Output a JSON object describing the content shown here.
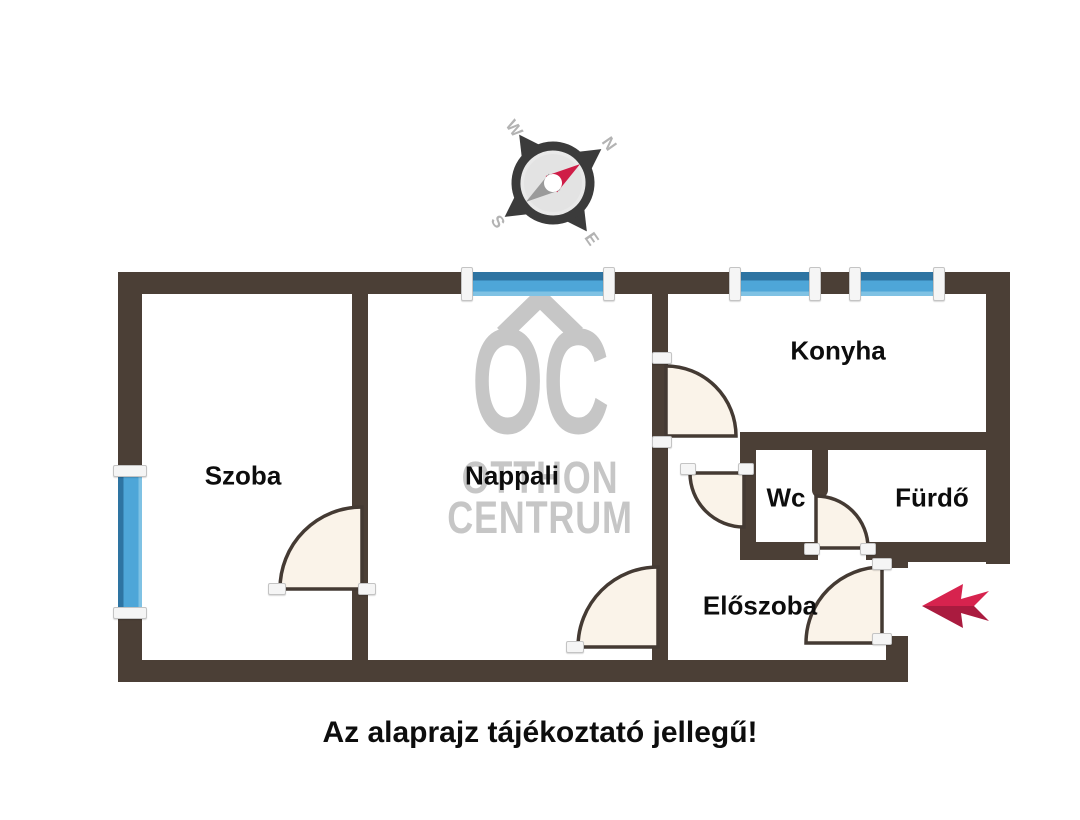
{
  "caption": "Az alaprajz tájékoztató jellegű!",
  "compass": {
    "n": "N",
    "e": "E",
    "s": "S",
    "w": "W",
    "needle_color": "#cf1d47",
    "tail_color": "#9a9a9a",
    "ring_color": "#3b3b3b"
  },
  "watermark": {
    "brand_initials": "OC",
    "line1": "OTTHON",
    "line2": "CENTRUM",
    "color": "#c6c6c6"
  },
  "colors": {
    "wall": "#4b3f36",
    "window_blue": "#4ea6d8",
    "window_blue_dark": "#2e74a2",
    "door_fill": "#faf3e9",
    "door_stroke": "#443a33",
    "arrow_red": "#d7234e",
    "arrow_red_dark": "#aa1b3f",
    "label_black": "#0d0d0d",
    "watermark_gray": "#c6c6c6"
  },
  "rooms": [
    {
      "id": "szoba",
      "label": "Szoba",
      "x": 243,
      "y": 476
    },
    {
      "id": "nappali",
      "label": "Nappali",
      "x": 512,
      "y": 476
    },
    {
      "id": "konyha",
      "label": "Konyha",
      "x": 838,
      "y": 351
    },
    {
      "id": "wc",
      "label": "Wc",
      "x": 786,
      "y": 498
    },
    {
      "id": "furdo",
      "label": "Fürdő",
      "x": 932,
      "y": 498
    },
    {
      "id": "eloszoba",
      "label": "Előszoba",
      "x": 760,
      "y": 606
    }
  ],
  "walls": [
    {
      "id": "outer-top",
      "x": 118,
      "y": 272,
      "w": 892,
      "h": 22
    },
    {
      "id": "outer-left",
      "x": 118,
      "y": 272,
      "w": 24,
      "h": 410
    },
    {
      "id": "outer-bottom",
      "x": 118,
      "y": 660,
      "w": 790,
      "h": 22
    },
    {
      "id": "outer-right",
      "x": 986,
      "y": 272,
      "w": 24,
      "h": 292
    },
    {
      "id": "furdo-bottom",
      "x": 886,
      "y": 542,
      "w": 124,
      "h": 20
    },
    {
      "id": "eloszoba-right-upper",
      "x": 886,
      "y": 542,
      "w": 22,
      "h": 26
    },
    {
      "id": "eloszoba-right-lower",
      "x": 886,
      "y": 636,
      "w": 22,
      "h": 46
    },
    {
      "id": "szoba-nappali-divider",
      "x": 352,
      "y": 290,
      "w": 16,
      "h": 376
    },
    {
      "id": "nappali-right",
      "x": 652,
      "y": 290,
      "w": 16,
      "h": 376
    },
    {
      "id": "konyha-bottom",
      "x": 740,
      "y": 432,
      "w": 270,
      "h": 18
    },
    {
      "id": "wc-left",
      "x": 740,
      "y": 432,
      "w": 16,
      "h": 126
    },
    {
      "id": "wc-furdo-divider",
      "x": 812,
      "y": 432,
      "w": 16,
      "h": 66,
      "rounded": true
    },
    {
      "id": "wc-bottom",
      "x": 740,
      "y": 542,
      "w": 78,
      "h": 18
    },
    {
      "id": "entry-bottom-stub",
      "x": 866,
      "y": 542,
      "w": 22,
      "h": 18
    }
  ],
  "windows": [
    {
      "id": "window-top-nappali",
      "o": "h",
      "x": 468,
      "y": 272,
      "w": 140,
      "h": 24
    },
    {
      "id": "window-top-konyha-1",
      "o": "h",
      "x": 736,
      "y": 272,
      "w": 78,
      "h": 24
    },
    {
      "id": "window-top-konyha-2",
      "o": "h",
      "x": 856,
      "y": 272,
      "w": 82,
      "h": 24
    },
    {
      "id": "window-left-szoba",
      "o": "v",
      "x": 118,
      "y": 472,
      "w": 24,
      "h": 138
    }
  ],
  "caps": [
    {
      "x": 461,
      "y": 267,
      "w": 10,
      "h": 32
    },
    {
      "x": 603,
      "y": 267,
      "w": 10,
      "h": 32
    },
    {
      "x": 729,
      "y": 267,
      "w": 10,
      "h": 32
    },
    {
      "x": 809,
      "y": 267,
      "w": 10,
      "h": 32
    },
    {
      "x": 849,
      "y": 267,
      "w": 10,
      "h": 32
    },
    {
      "x": 933,
      "y": 267,
      "w": 10,
      "h": 32
    },
    {
      "x": 113,
      "y": 465,
      "w": 32,
      "h": 10
    },
    {
      "x": 113,
      "y": 607,
      "w": 32,
      "h": 10
    },
    {
      "x": 652,
      "y": 352,
      "w": 18,
      "h": 10
    },
    {
      "x": 652,
      "y": 436,
      "w": 18,
      "h": 10
    },
    {
      "x": 268,
      "y": 583,
      "w": 16,
      "h": 10
    },
    {
      "x": 358,
      "y": 583,
      "w": 16,
      "h": 10
    },
    {
      "x": 566,
      "y": 641,
      "w": 16,
      "h": 10
    },
    {
      "x": 680,
      "y": 463,
      "w": 14,
      "h": 10
    },
    {
      "x": 738,
      "y": 463,
      "w": 14,
      "h": 10
    },
    {
      "x": 804,
      "y": 543,
      "w": 14,
      "h": 10
    },
    {
      "x": 860,
      "y": 543,
      "w": 14,
      "h": 10
    },
    {
      "x": 872,
      "y": 558,
      "w": 18,
      "h": 10
    },
    {
      "x": 872,
      "y": 633,
      "w": 18,
      "h": 10
    }
  ],
  "doors": [
    {
      "id": "konyha-door",
      "path": "M666,436 L666,366 A70,70 0 0 1 736,436 Z"
    },
    {
      "id": "szoba-door",
      "path": "M362,589 L362,507 A82,82 0 0 0 280,589 Z"
    },
    {
      "id": "nappali-door",
      "path": "M658,647 L658,567 A80,80 0 0 0 578,647 Z"
    },
    {
      "id": "wc-door",
      "path": "M744,473 L690,473 A54,54 0 0 0 744,527 Z"
    },
    {
      "id": "furdo-door",
      "path": "M816,548 L816,496 A52,52 0 0 1 868,548 Z"
    },
    {
      "id": "entry-door",
      "path": "M882,643 L882,567 A76,76 0 0 0 806,643 Z"
    }
  ],
  "entry_arrow": {
    "points_top": "922,606 963,584 961,599 989,591 974,606",
    "points_bottom": "922,606 974,606 989,621 961,613 963,628"
  }
}
